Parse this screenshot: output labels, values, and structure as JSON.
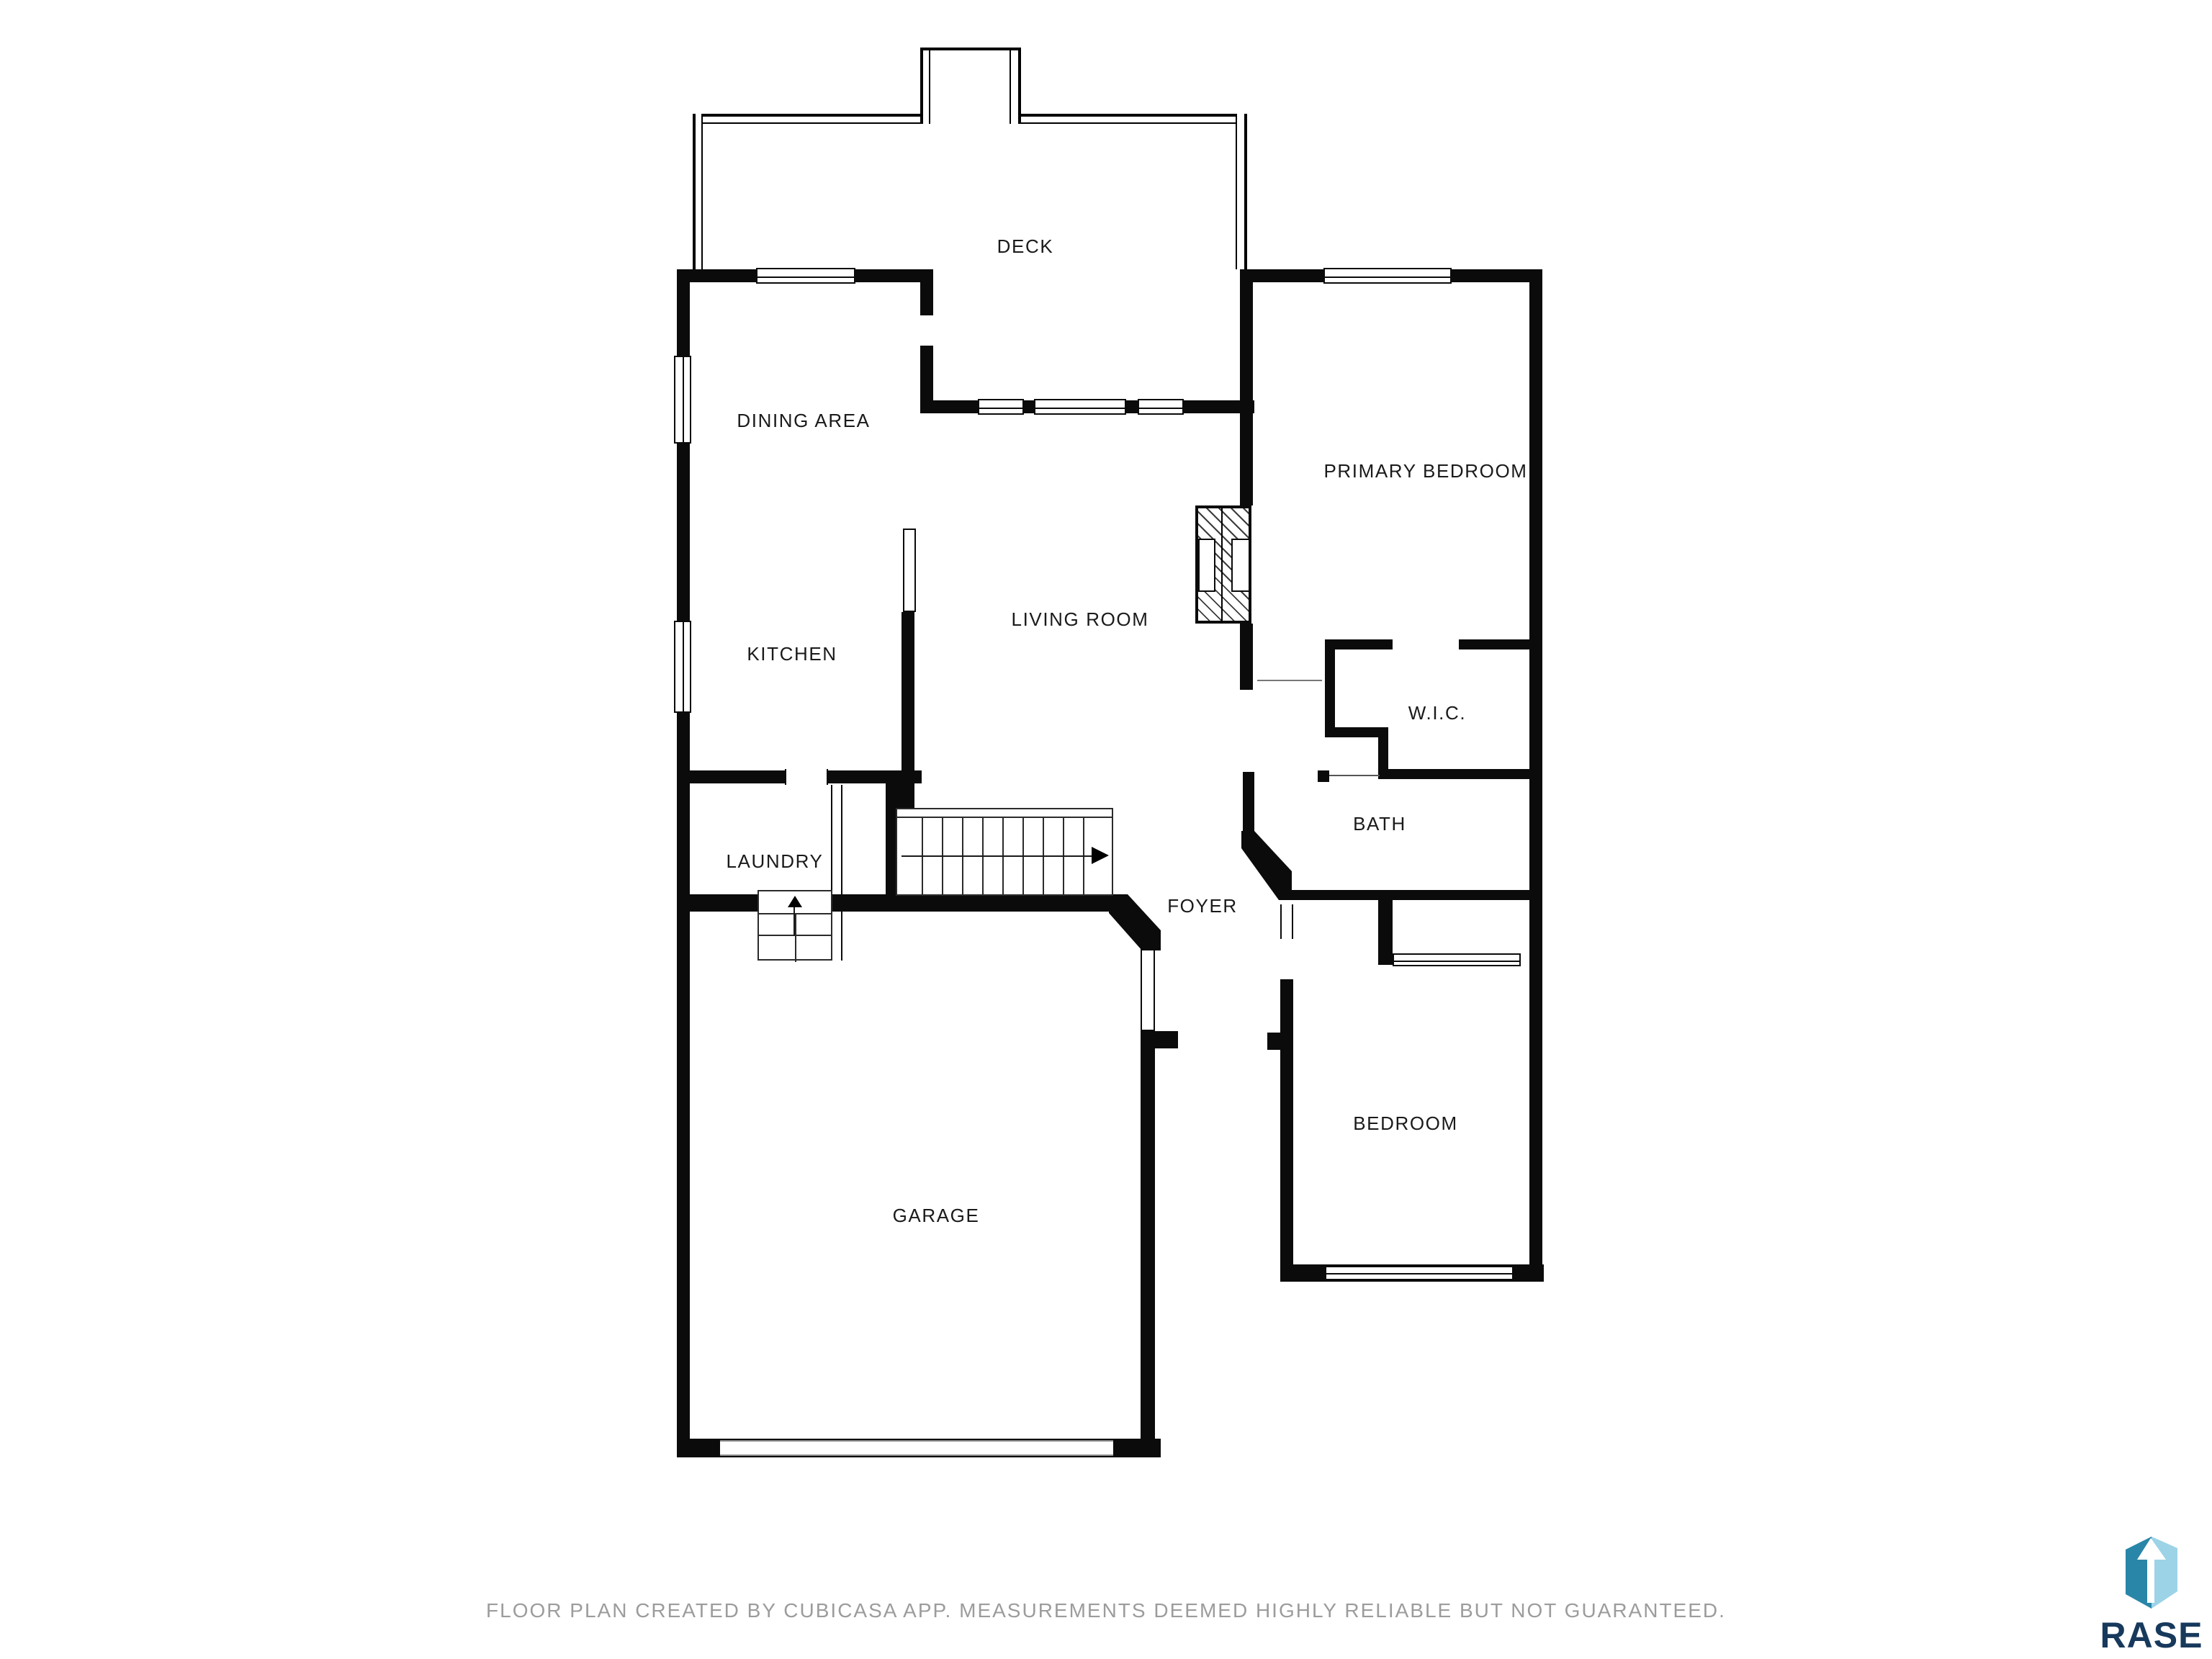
{
  "document": {
    "type": "floor-plan",
    "background_color": "#ffffff",
    "wall_color": "#0b0b0b",
    "label_color": "#1a1a1a"
  },
  "floor_plan": {
    "rooms": {
      "deck": {
        "label": "DECK"
      },
      "dining_area": {
        "label": "DINING AREA"
      },
      "primary_bedroom": {
        "label": "PRIMARY BEDROOM"
      },
      "living_room": {
        "label": "LIVING ROOM"
      },
      "kitchen": {
        "label": "KITCHEN"
      },
      "wic": {
        "label": "W.I.C."
      },
      "bath": {
        "label": "BATH"
      },
      "laundry": {
        "label": "LAUNDRY"
      },
      "foyer": {
        "label": "FOYER"
      },
      "bedroom": {
        "label": "BEDROOM"
      },
      "garage": {
        "label": "GARAGE"
      }
    },
    "features": {
      "main_stairs_direction_icon": "right-arrow-icon",
      "entry_steps_direction_icon": "up-arrow-icon",
      "fireplace_style": "diagonal-hatch"
    }
  },
  "footer": {
    "disclaimer": "FLOOR PLAN CREATED BY CUBICASA APP. MEASUREMENTS DEEMED HIGHLY RELIABLE BUT NOT GUARANTEED.",
    "text_color": "#9c9c9c"
  },
  "logo": {
    "brand": "RASE",
    "icon": "cube-up-arrow-icon",
    "colors": {
      "navy": "#17395c",
      "teal": "#2a86a8",
      "light_blue": "#9cd3e7"
    }
  }
}
